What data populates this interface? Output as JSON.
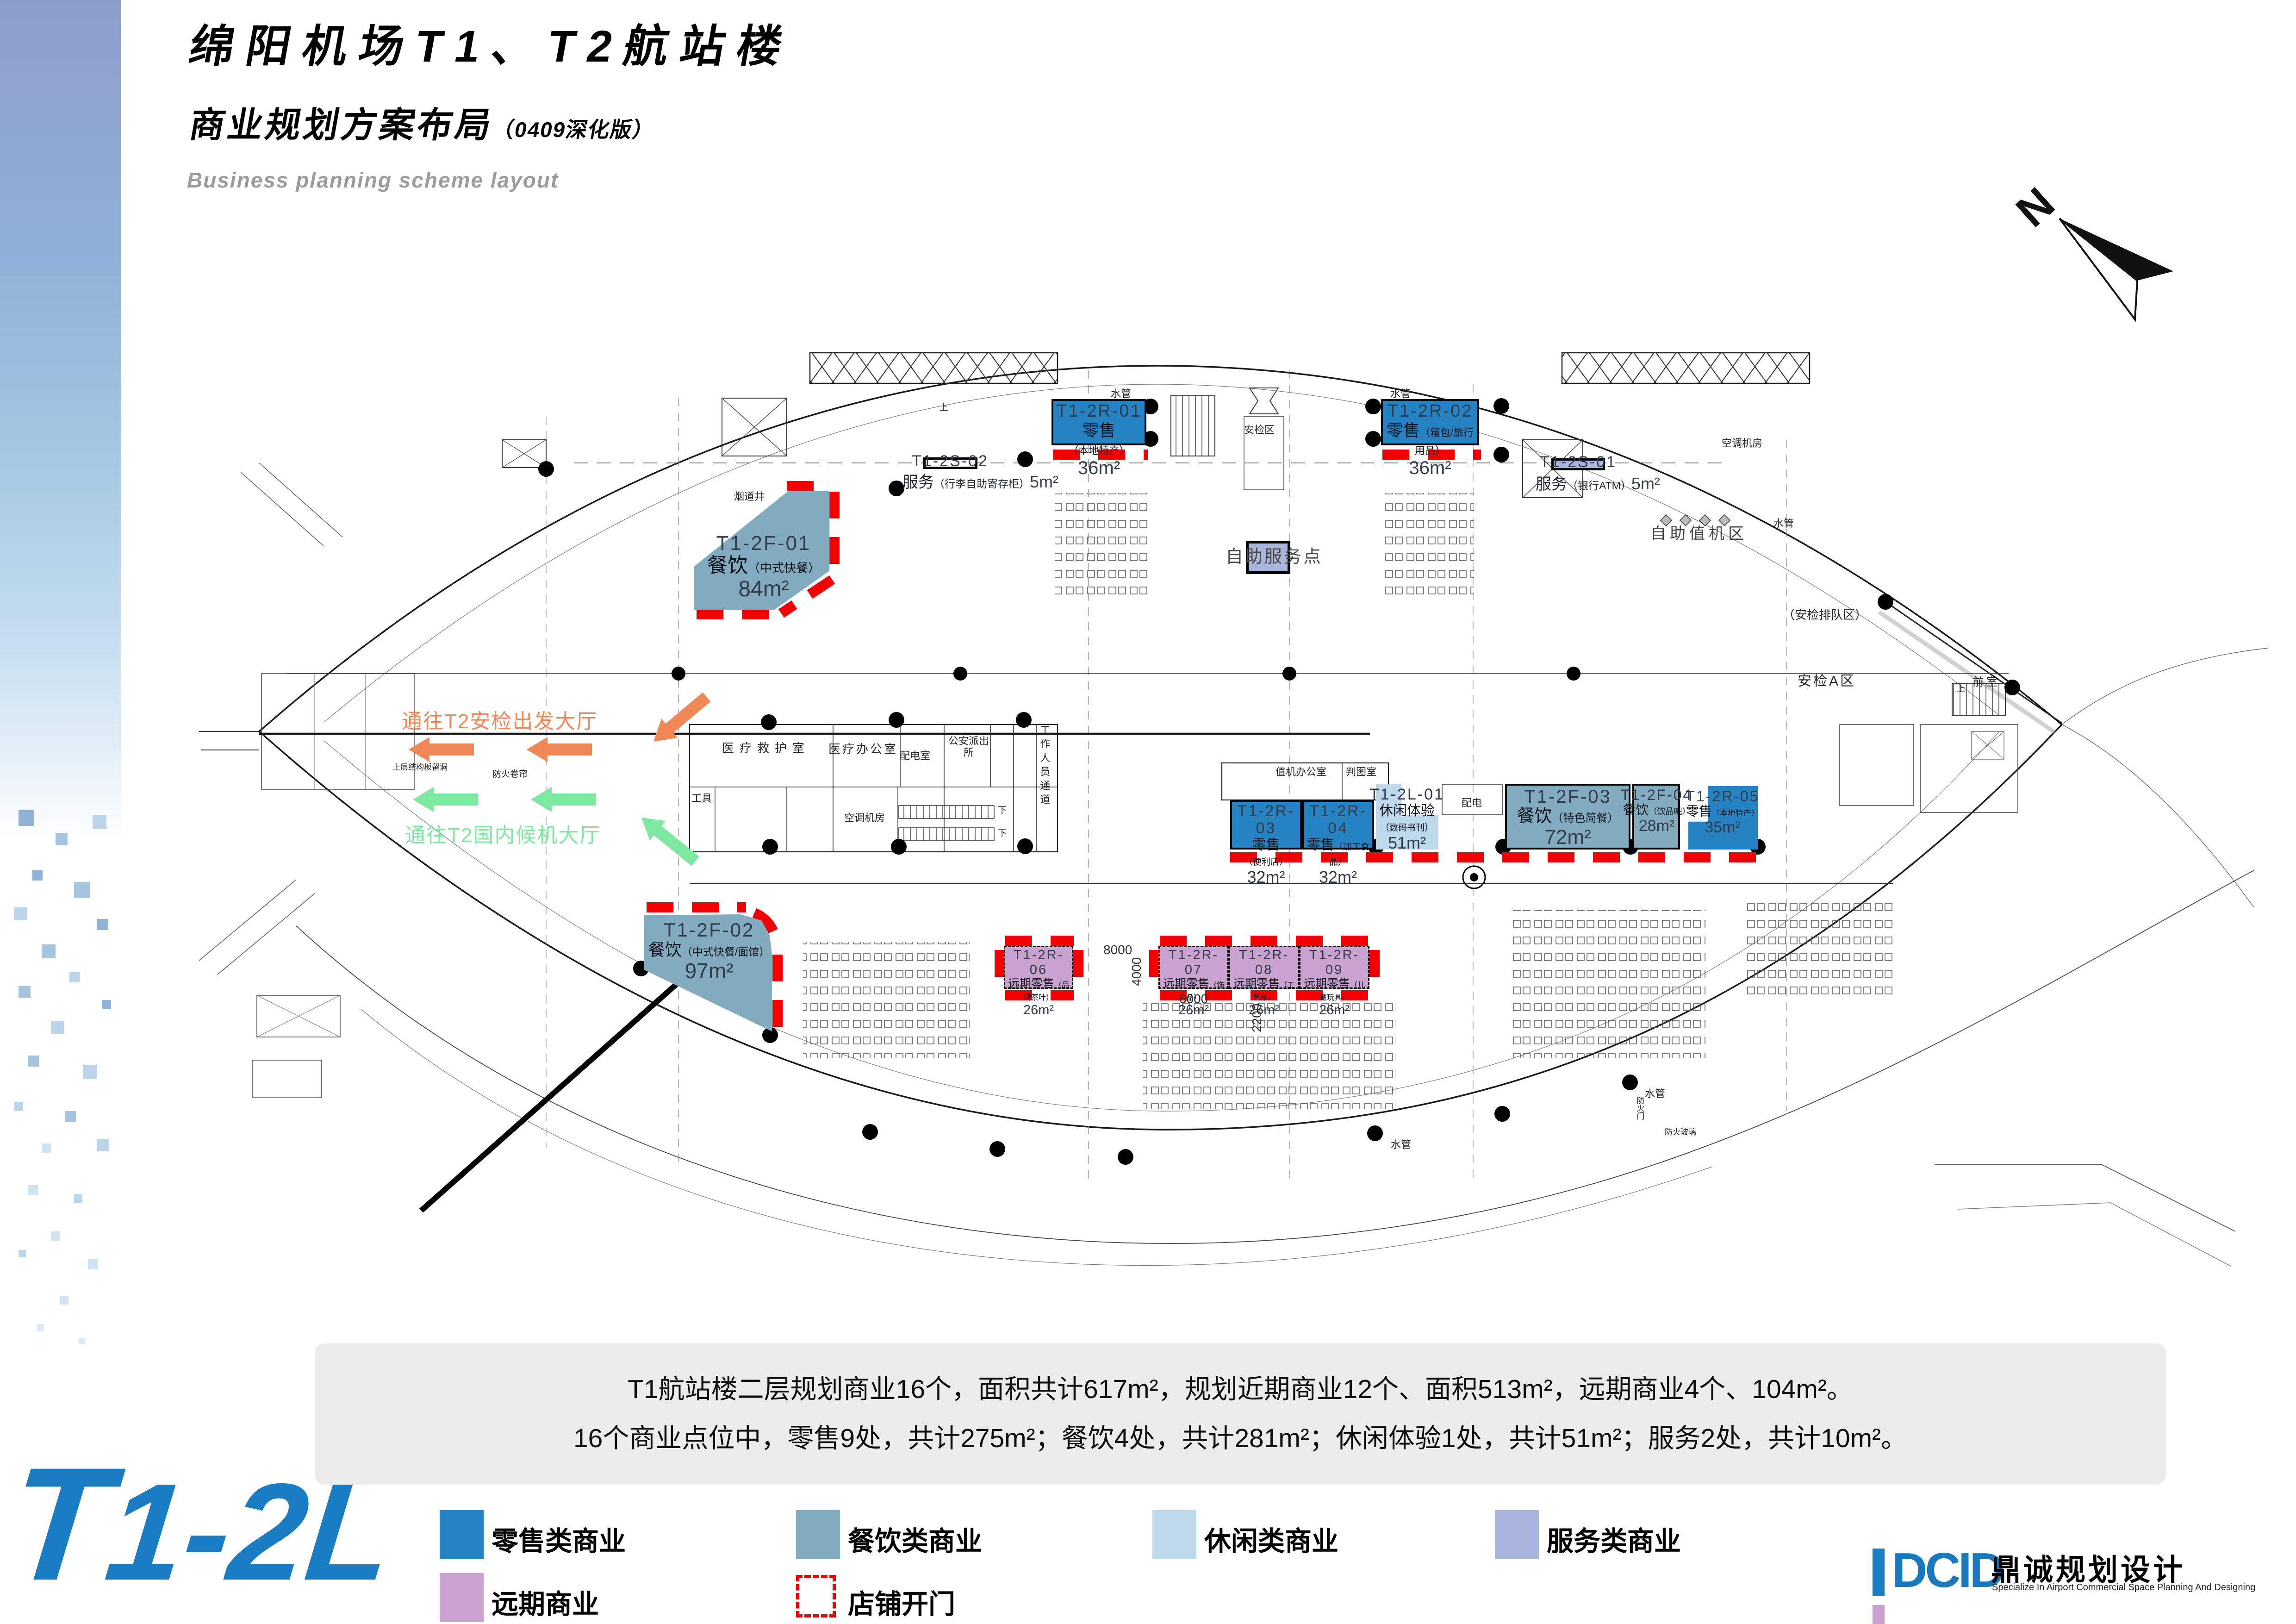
{
  "header": {
    "title": "绵阳机场T1、T2航站楼",
    "subtitle": "商业规划方案布局",
    "subtitle_note": "（0409深化版）",
    "subtitle_en": "Business planning scheme layout"
  },
  "compass": {
    "label": "N"
  },
  "plan": {
    "labels": [
      "安检区",
      "水管",
      "水管",
      "水管",
      "水管",
      "水管",
      "烟道井",
      "自助服务点",
      "自助值机区",
      "（安检排队区）",
      "安检A区",
      "前室",
      "医疗救护室",
      "医疗办公室",
      "配电室",
      "公安派出所",
      "工作人员通道",
      "工具",
      "空调机房",
      "空调机房",
      "值机办公室",
      "判图室",
      "配电",
      "防火卷帘",
      "防火门",
      "防火玻璃",
      "上层结构板留洞",
      "下",
      "下",
      "上",
      "上"
    ],
    "dims": [
      "8000",
      "4000",
      "6000",
      "2200"
    ],
    "wayfinding": {
      "to_security": "通往T2安检出发大厅",
      "to_domestic": "通往T2国内候机大厅"
    },
    "shops": [
      {
        "id": "T1-2R-01",
        "name": "零售",
        "detail": "（本地特产）",
        "area": "36m²",
        "category": "retail"
      },
      {
        "id": "T1-2R-02",
        "name": "零售",
        "detail": "（箱包/旅行用品）",
        "area": "36m²",
        "category": "retail"
      },
      {
        "id": "T1-2F-01",
        "name": "餐饮",
        "detail": "（中式快餐）",
        "area": "84m²",
        "category": "food"
      },
      {
        "id": "T1-2S-02",
        "name": "服务",
        "detail": "（行李自助寄存柜）",
        "area": "5m²",
        "category": "service"
      },
      {
        "id": "T1-2S-01",
        "name": "服务",
        "detail": "（银行ATM）",
        "area": "5m²",
        "category": "service"
      },
      {
        "id": "T1-2R-03",
        "name": "零售",
        "detail": "（便利店）",
        "area": "32m²",
        "category": "retail"
      },
      {
        "id": "T1-2R-04",
        "name": "零售",
        "detail": "（加工食品）",
        "area": "32m²",
        "category": "retail"
      },
      {
        "id": "T1-2L-01",
        "name": "休闲体验",
        "detail": "（数码书刊）",
        "area": "51m²",
        "category": "leisure"
      },
      {
        "id": "T1-2F-03",
        "name": "餐饮",
        "detail": "（特色简餐）",
        "area": "72m²",
        "category": "food"
      },
      {
        "id": "T1-2F-04",
        "name": "餐饮",
        "detail": "（饮品吧）",
        "area": "28m²",
        "category": "food"
      },
      {
        "id": "T1-2R-05",
        "name": "零售",
        "detail": "（本地特产）",
        "area": "35m²",
        "category": "retail"
      },
      {
        "id": "T1-2F-02",
        "name": "餐饮",
        "detail": "（中式快餐/面馆）",
        "area": "97m²",
        "category": "food"
      },
      {
        "id": "T1-2R-06",
        "name": "远期零售",
        "detail": "（品牌茶叶）",
        "area": "26m²",
        "category": "future"
      },
      {
        "id": "T1-2R-07",
        "name": "远期零售",
        "detail": "（饰品）",
        "area": "26m²",
        "category": "future"
      },
      {
        "id": "T1-2R-08",
        "name": "远期零售",
        "detail": "（工艺品）",
        "area": "26m²",
        "category": "future"
      },
      {
        "id": "T1-2R-09",
        "name": "远期零售",
        "detail": "（儿童玩具）",
        "area": "26m²",
        "category": "future"
      }
    ]
  },
  "summary": {
    "line1": "T1航站楼二层规划商业16个，面积共计617m²，规划近期商业12个、面积513m²，远期商业4个、104m²。",
    "line2": "16个商业点位中，零售9处，共计275m²；餐饮4处，共计281m²；休闲体验1处，共计51m²；服务2处，共计10m²。"
  },
  "legend": {
    "items": [
      {
        "label": "零售类商业",
        "color": "#2583c4"
      },
      {
        "label": "餐饮类商业",
        "color": "#83abc0"
      },
      {
        "label": "休闲类商业",
        "color": "#bcd8ea"
      },
      {
        "label": "服务类商业",
        "color": "#a9b5dd"
      },
      {
        "label": "远期商业",
        "color": "#c9a2cf"
      },
      {
        "label": "店铺开门",
        "color": "#f40000"
      }
    ]
  },
  "footer": {
    "floor_code_t": "T",
    "floor_code_rest": "1-2L",
    "logo": "DCID",
    "logo_cn": "鼎诚规划设计",
    "logo_en": "Specialize In Airport Commercial Space Planning And Designing"
  },
  "colors": {
    "retail": "#2583c4",
    "food": "#83abc0",
    "leisure": "#bcd8ea",
    "service": "#a9b5dd",
    "future": "#c9a2cf",
    "open_door_red": "#f40000",
    "arrow_orange": "#ef8757",
    "arrow_green": "#7de89f",
    "brand_blue": "#1a7cc2"
  }
}
